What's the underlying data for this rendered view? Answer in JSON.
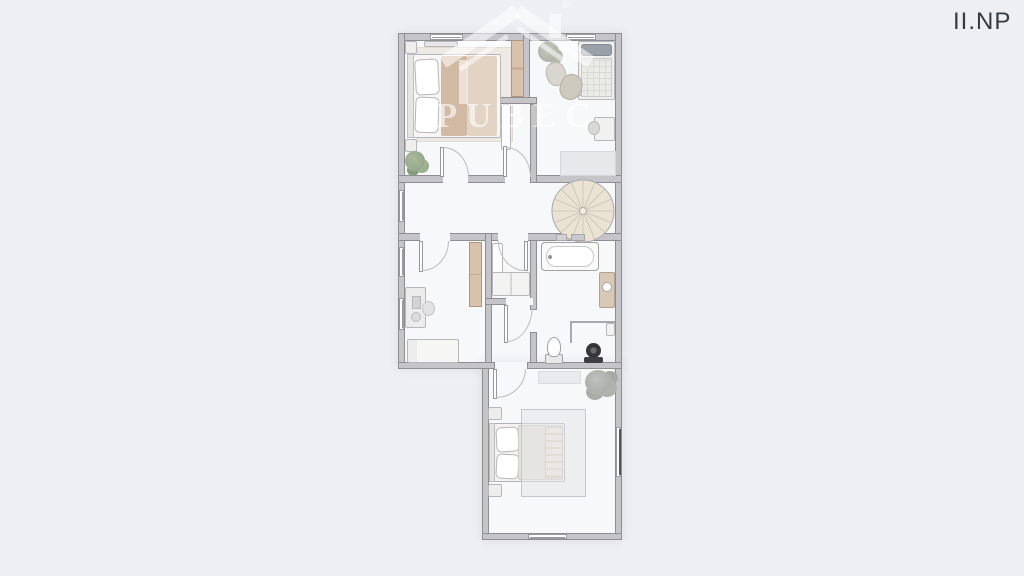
{
  "page": {
    "background_color": "#edeff2",
    "floor_label": "II.NP"
  },
  "watermark": {
    "brand": "PUBEC",
    "registered_mark": "®"
  },
  "palette": {
    "floor": "#f7f8fa",
    "wall_fill": "#c5c5c9",
    "wall_outline": "#8e8e93",
    "wood_closet": "#d8c2ab",
    "blanket_dark": "#d2b9a4",
    "blanket_light": "#e3d3c2",
    "stair_fill": "#eae3d4",
    "plant_green": "#8da083",
    "plant_grey": "#a4a6a2",
    "label_color": "#363b42"
  },
  "floorplan": {
    "level": "II.NP",
    "rooms": [
      {
        "name": "bedroom-top-left",
        "furniture": [
          "double-bed",
          "rug",
          "nightstand",
          "nightstand",
          "wall-shelf",
          "wardrobe",
          "plant"
        ]
      },
      {
        "name": "bedroom-top-right",
        "furniture": [
          "single-bed",
          "side-table",
          "plant",
          "armchair",
          "armchair",
          "desk",
          "chair",
          "rug"
        ]
      },
      {
        "name": "hallway",
        "furniture": [
          "spiral-staircase"
        ],
        "windows": 1
      },
      {
        "name": "study-bedroom",
        "furniture": [
          "desk",
          "chair",
          "daybed",
          "wardrobe"
        ],
        "windows": 2
      },
      {
        "name": "closet-room",
        "furniture": [
          "cabinet",
          "bench"
        ]
      },
      {
        "name": "bathroom",
        "furniture": [
          "bathtub",
          "vanity-sink",
          "toilet",
          "corner-rail",
          "pedestal-fan"
        ]
      },
      {
        "name": "bedroom-bottom",
        "furniture": [
          "double-bed",
          "rug",
          "nightstand",
          "nightstand",
          "doormat",
          "plant"
        ],
        "windows": 2
      }
    ]
  }
}
